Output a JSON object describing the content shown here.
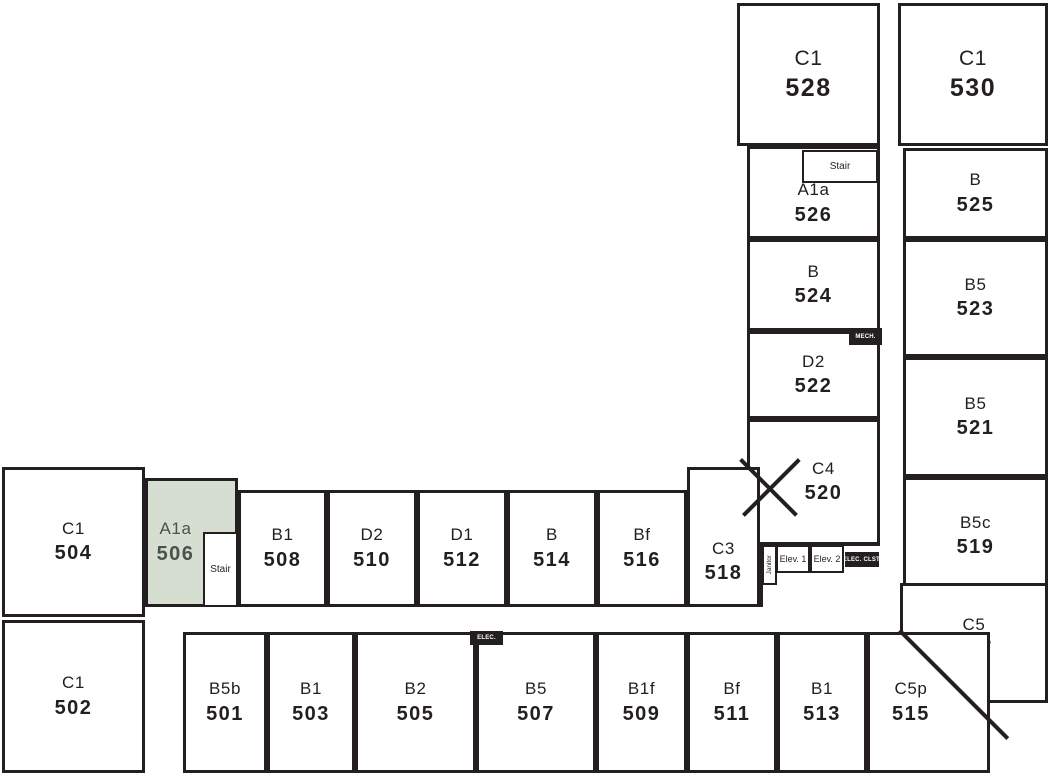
{
  "colors": {
    "wall": "#231f20",
    "highlight_fill": "#d5ded1",
    "highlight_text": "#49524a",
    "background": "#ffffff"
  },
  "units": [
    {
      "type": "C1",
      "number": "528"
    },
    {
      "type": "C1",
      "number": "530"
    },
    {
      "type": "A1a",
      "number": "526"
    },
    {
      "type": "B",
      "number": "525"
    },
    {
      "type": "B",
      "number": "524"
    },
    {
      "type": "B5",
      "number": "523"
    },
    {
      "type": "D2",
      "number": "522"
    },
    {
      "type": "B5",
      "number": "521"
    },
    {
      "type": "C4",
      "number": "520"
    },
    {
      "type": "B5c",
      "number": "519"
    },
    {
      "type": "C5",
      "number": "517"
    },
    {
      "type": "C1",
      "number": "504"
    },
    {
      "type": "A1a",
      "number": "506",
      "highlighted": true
    },
    {
      "type": "B1",
      "number": "508"
    },
    {
      "type": "D2",
      "number": "510"
    },
    {
      "type": "D1",
      "number": "512"
    },
    {
      "type": "B",
      "number": "514"
    },
    {
      "type": "Bf",
      "number": "516"
    },
    {
      "type": "C3",
      "number": "518"
    },
    {
      "type": "C1",
      "number": "502"
    },
    {
      "type": "B5b",
      "number": "501"
    },
    {
      "type": "B1",
      "number": "503"
    },
    {
      "type": "B2",
      "number": "505"
    },
    {
      "type": "B5",
      "number": "507"
    },
    {
      "type": "B1f",
      "number": "509"
    },
    {
      "type": "Bf",
      "number": "511"
    },
    {
      "type": "B1",
      "number": "513"
    },
    {
      "type": "C5p",
      "number": "515"
    }
  ],
  "labels": {
    "stair_upper": "Stair",
    "stair_lower": "Stair",
    "elev_1": "Elev. 1",
    "elev_2": "Elev. 2",
    "janitor": "Janitor",
    "mech": "MECH.",
    "elec": "ELEC.",
    "elec_closet": "ELEC. CLST."
  }
}
